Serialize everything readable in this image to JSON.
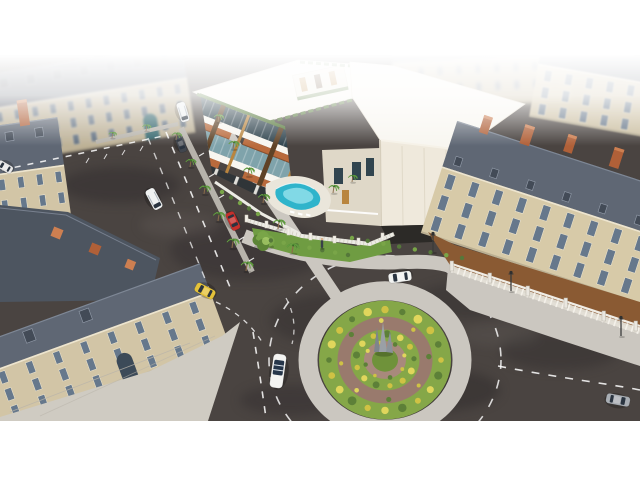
{
  "image_alt": "Aerial 3D architectural rendering: modern white residential complex with courtyard pool and palm-lined avenue, surrounded by classical mansard-roof buildings and a landscaped traffic roundabout",
  "palette": {
    "white": "#ffffff",
    "asphalt": "#4a4441",
    "asphaltDark": "#332f2e",
    "asphaltLight": "#5e5752",
    "sidewalk": "#cbc7c0",
    "plaza": "#cfcbc2",
    "median": "#b7b3ab",
    "slateRoof": "#5f6774",
    "slateLight": "#7d8694",
    "slateDark": "#4d5560",
    "facade": "#d2c5a6",
    "facadeRight": "#d7caa8",
    "facadeLight": "#e2d7ba",
    "windowGlass": "#66788c",
    "windowFrame": "#efe7d2",
    "chimney": "#b06038",
    "chimneyLight": "#cd7f51",
    "doorTeal": "#2e6b74",
    "modernWhite": "#f1ece1",
    "modernShade": "#dfd8c8",
    "modernRoof": "#f8f6f0",
    "monolith": "#efe9dc",
    "wood": "#b9853e",
    "woodDark": "#5f4226",
    "awning": "#b96a3c",
    "glassDark": "#31454f",
    "glassTeal": "#7fa3ab",
    "hedge": "#55783a",
    "lawn": "#6f9c42",
    "grass": "#85a748",
    "grassDark": "#6f923a",
    "brickRing": "#997a6d",
    "brickLight": "#a8897c",
    "bushYellow": "#cfc244",
    "bushYellowLight": "#e0d65c",
    "bushGreen": "#5d8038",
    "poolWater": "#2fb4cb",
    "poolShallow": "#8fdfeb",
    "deck": "#eae6db",
    "courtyard": "#8a5a33",
    "courtyardLight": "#9c6a3e",
    "balustrade": "#eae7e0",
    "storefront": "#303538",
    "fence": "#ecebe4",
    "treeGreen": "#79a548",
    "treeDark": "#5c8436",
    "lamp": "#3b3b3b"
  },
  "roundabout": {
    "cx": 385,
    "cy": 360,
    "squash": 0.9,
    "island_r": 66,
    "sidewalk_r": 77,
    "sidewalk_w": 19,
    "brick_r": 41,
    "brick_w": 13,
    "inner_disc_r": 21,
    "center_r": 13,
    "dash_r": 116,
    "bush_rings": [
      {
        "r": 56,
        "count": 20,
        "rmin": 2.8,
        "rmax": 4.6
      },
      {
        "r": 44,
        "count": 8,
        "rmin": 2.0,
        "rmax": 2.8
      },
      {
        "r": 29,
        "count": 13,
        "rmin": 2.6,
        "rmax": 3.8
      },
      {
        "r": 20,
        "count": 8,
        "rmin": 1.8,
        "rmax": 2.4
      }
    ]
  },
  "buildings": [
    {
      "target": "bN",
      "name": "distant-block-north",
      "cls": "hazy",
      "rot": -3,
      "cx": 480,
      "cy": 80,
      "roof": {
        "x": 393,
        "y": 40,
        "w": 178,
        "h": 18
      },
      "facade": {
        "x": 393,
        "y": 58,
        "w": 178,
        "h": 48
      },
      "windows": {
        "rows": 2,
        "cols": 9,
        "x0": 400,
        "y0": 64,
        "dx": 19,
        "dy": 18,
        "w": 5,
        "h": 9
      }
    },
    {
      "target": "bB5",
      "name": "mansion-northeast",
      "cls": "soft",
      "rot": 10,
      "cx": 595,
      "cy": 100,
      "roof": {
        "x": 533,
        "y": 50,
        "w": 132,
        "h": 24
      },
      "facade": {
        "x": 533,
        "y": 74,
        "w": 132,
        "h": 54
      },
      "windows": {
        "rows": 3,
        "cols": 6,
        "x0": 541,
        "y0": 79,
        "dx": 21,
        "dy": 17,
        "w": 7,
        "h": 11
      }
    },
    {
      "target": "bA",
      "name": "mansion-north",
      "cls": "fade",
      "rot": -9,
      "cx": 95,
      "cy": 105,
      "roof": {
        "x": -12,
        "y": 58,
        "w": 202,
        "h": 34
      },
      "dormers": {
        "y": 64,
        "count": 7,
        "start": 4,
        "step": 27,
        "w": 9,
        "h": 10
      },
      "facade": {
        "x": -12,
        "y": 92,
        "w": 202,
        "h": 56
      },
      "windows": {
        "rows": 3,
        "cols": 11,
        "x0": -4,
        "y0": 97,
        "dx": 18,
        "dy": 17,
        "w": 6,
        "h": 10
      },
      "door": {
        "x": 140,
        "y": 122,
        "w": 14,
        "h": 26,
        "fill": "doorTeal"
      }
    },
    {
      "target": "bB2",
      "name": "mansion-west-upper",
      "rot": -8,
      "cx": 55,
      "cy": 180,
      "roof": {
        "x": -28,
        "y": 118,
        "w": 94,
        "h": 48
      },
      "dormers": {
        "y": 126,
        "count": 3,
        "start": -18,
        "step": 30,
        "w": 8,
        "h": 9
      },
      "chimneys": [
        {
          "x": -6,
          "y": 102,
          "w": 9,
          "h": 20
        },
        {
          "x": 28,
          "y": 96,
          "w": 10,
          "h": 26
        }
      ],
      "facade": {
        "x": -28,
        "y": 166,
        "w": 94,
        "h": 50
      },
      "windows": {
        "rows": 2,
        "cols": 5,
        "x0": -20,
        "y0": 172,
        "dx": 19,
        "dy": 21,
        "w": 6,
        "h": 11
      }
    },
    {
      "target": "bB3",
      "name": "mansion-southwest",
      "rot": -20,
      "cx": 100,
      "cy": 340,
      "roof": {
        "x": -45,
        "y": 302,
        "w": 265,
        "h": 30
      },
      "dormers": {
        "y": 306,
        "count": 3,
        "start": -30,
        "step": 60,
        "w": 10,
        "h": 12
      },
      "facade": {
        "x": -45,
        "y": 332,
        "w": 265,
        "h": 56
      },
      "windows": {
        "rows": 3,
        "cols": 9,
        "x0": -36,
        "y0": 336,
        "dx": 29,
        "dy": 18,
        "w": 7,
        "h": 12
      },
      "door": {
        "x": 108,
        "y": 360,
        "w": 16,
        "h": 28,
        "fill": "#3c4a58"
      }
    },
    {
      "target": "bB4",
      "name": "mansion-east",
      "rot": 18,
      "cx": 540,
      "cy": 235,
      "roof": {
        "x": 426,
        "y": 152,
        "w": 250,
        "h": 48
      },
      "dormers": {
        "y": 186,
        "count": 6,
        "start": 436,
        "step": 38,
        "w": 7,
        "h": 9
      },
      "chimneys": [
        {
          "x": 450,
          "y": 138,
          "w": 9,
          "h": 18
        },
        {
          "x": 492,
          "y": 134,
          "w": 10,
          "h": 20
        },
        {
          "x": 536,
          "y": 130,
          "w": 9,
          "h": 18
        },
        {
          "x": 584,
          "y": 128,
          "w": 10,
          "h": 20
        },
        {
          "x": 628,
          "y": 126,
          "w": 9,
          "h": 18
        }
      ],
      "facade": {
        "x": 426,
        "y": 200,
        "w": 250,
        "h": 70
      },
      "facadeFill": "facadeRight",
      "windows": {
        "rows": 3,
        "cols": 10,
        "x0": 434,
        "y0": 205,
        "dx": 25,
        "dy": 22,
        "w": 8,
        "h": 15
      }
    }
  ],
  "cars": [
    {
      "name": "car-white-van-north",
      "kind": "van",
      "color": "#eceff0",
      "x": 183,
      "y": 112,
      "rot": 163,
      "w": 9,
      "len": 20
    },
    {
      "name": "car-dark-parked",
      "kind": "sedan",
      "color": "#41464e",
      "x": 181,
      "y": 144,
      "rot": 160,
      "w": 8,
      "len": 17
    },
    {
      "name": "car-white-van-avenue",
      "kind": "van",
      "color": "#f0f2f2",
      "x": 154,
      "y": 199,
      "rot": 152,
      "w": 10,
      "len": 22
    },
    {
      "name": "car-red-parked",
      "kind": "sedan",
      "color": "#c5302c",
      "x": 233,
      "y": 221,
      "rot": 155,
      "w": 9,
      "len": 19
    },
    {
      "name": "car-yellow-taxi",
      "kind": "sedan",
      "color": "#e4c23a",
      "x": 205,
      "y": 291,
      "rot": -62,
      "w": 10,
      "len": 21
    },
    {
      "name": "car-white-convertible",
      "kind": "convertible",
      "color": "#f4f4f2",
      "x": 278,
      "y": 371,
      "rot": 8,
      "w": 13,
      "len": 34
    },
    {
      "name": "car-white-sedan-roundabout",
      "kind": "sedan",
      "color": "#f2f3f1",
      "x": 400,
      "y": 277,
      "rot": 262,
      "w": 10,
      "len": 23
    },
    {
      "name": "car-silver-east",
      "kind": "sedan",
      "color": "#a9aeb4",
      "x": 618,
      "y": 400,
      "rot": 101,
      "w": 10,
      "len": 24
    },
    {
      "name": "car-white-edge-west",
      "kind": "sedan",
      "color": "#e8e8e8",
      "x": 5,
      "y": 167,
      "rot": -60,
      "w": 8,
      "len": 16
    }
  ],
  "palms": [
    {
      "x": 112,
      "y": 138,
      "s": 0.65
    },
    {
      "x": 146,
      "y": 131,
      "s": 0.7
    },
    {
      "x": 176,
      "y": 140,
      "s": 0.8
    },
    {
      "x": 190,
      "y": 167,
      "s": 0.85
    },
    {
      "x": 204,
      "y": 194,
      "s": 0.9
    },
    {
      "x": 218,
      "y": 221,
      "s": 0.95
    },
    {
      "x": 232,
      "y": 248,
      "s": 1.0
    },
    {
      "x": 246,
      "y": 271,
      "s": 1.0
    },
    {
      "x": 218,
      "y": 122,
      "s": 0.8
    },
    {
      "x": 233,
      "y": 149,
      "s": 0.85
    },
    {
      "x": 248,
      "y": 176,
      "s": 0.9
    },
    {
      "x": 263,
      "y": 203,
      "s": 0.95
    },
    {
      "x": 278,
      "y": 229,
      "s": 1.0
    },
    {
      "x": 292,
      "y": 253,
      "s": 1.0
    },
    {
      "x": 333,
      "y": 193,
      "s": 0.85
    },
    {
      "x": 352,
      "y": 182,
      "s": 0.75
    }
  ],
  "bush_rows": [
    {
      "x1": 352,
      "y1": 238,
      "x2": 462,
      "y2": 258,
      "count": 8
    },
    {
      "x1": 258,
      "y1": 238,
      "x2": 348,
      "y2": 255,
      "count": 8
    },
    {
      "x1": 222,
      "y1": 192,
      "x2": 258,
      "y2": 214,
      "count": 5
    }
  ],
  "lamps": [
    {
      "x": 433,
      "y": 252
    },
    {
      "x": 511,
      "y": 291
    },
    {
      "x": 621,
      "y": 336
    }
  ],
  "person": {
    "x": 322,
    "y": 243
  },
  "tree": {
    "x": 263,
    "y": 243
  }
}
